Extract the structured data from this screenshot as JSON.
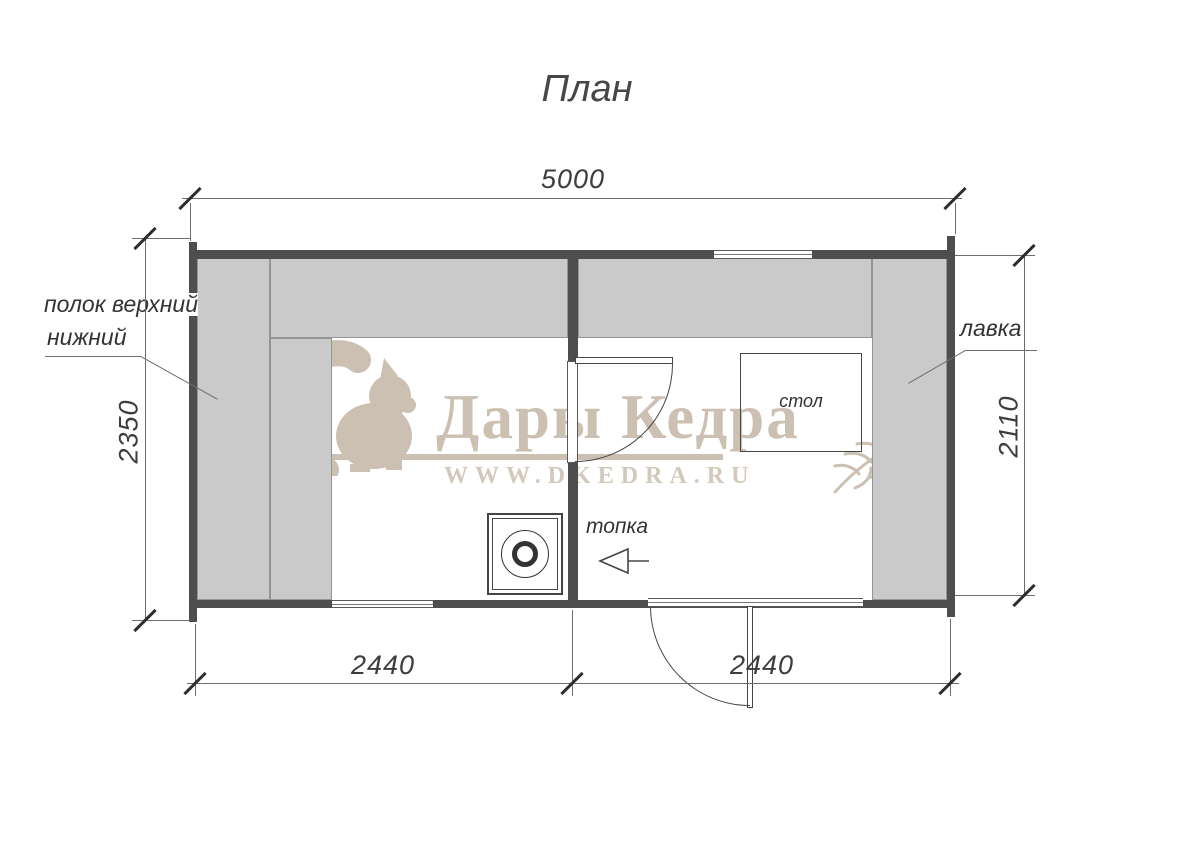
{
  "title": "План",
  "dimensions": {
    "top": "5000",
    "left": "2350",
    "right": "2110",
    "bottom_left": "2440",
    "bottom_right": "2440"
  },
  "labels": {
    "shelves_line1": "полок верхний",
    "shelves_line2": "нижний",
    "bench": "лавка",
    "table": "стол",
    "firebox": "топка"
  },
  "watermark": {
    "brand": "Дары Кедра",
    "website": "WWW.DKEDRA.RU"
  },
  "colors": {
    "wall": "#4e4e4e",
    "bench_fill": "#cbcaca",
    "bench_edge": "#959595",
    "line": "#6e6e6e",
    "text": "#3a3a3a",
    "watermark_beige": "#cbc0b2"
  }
}
